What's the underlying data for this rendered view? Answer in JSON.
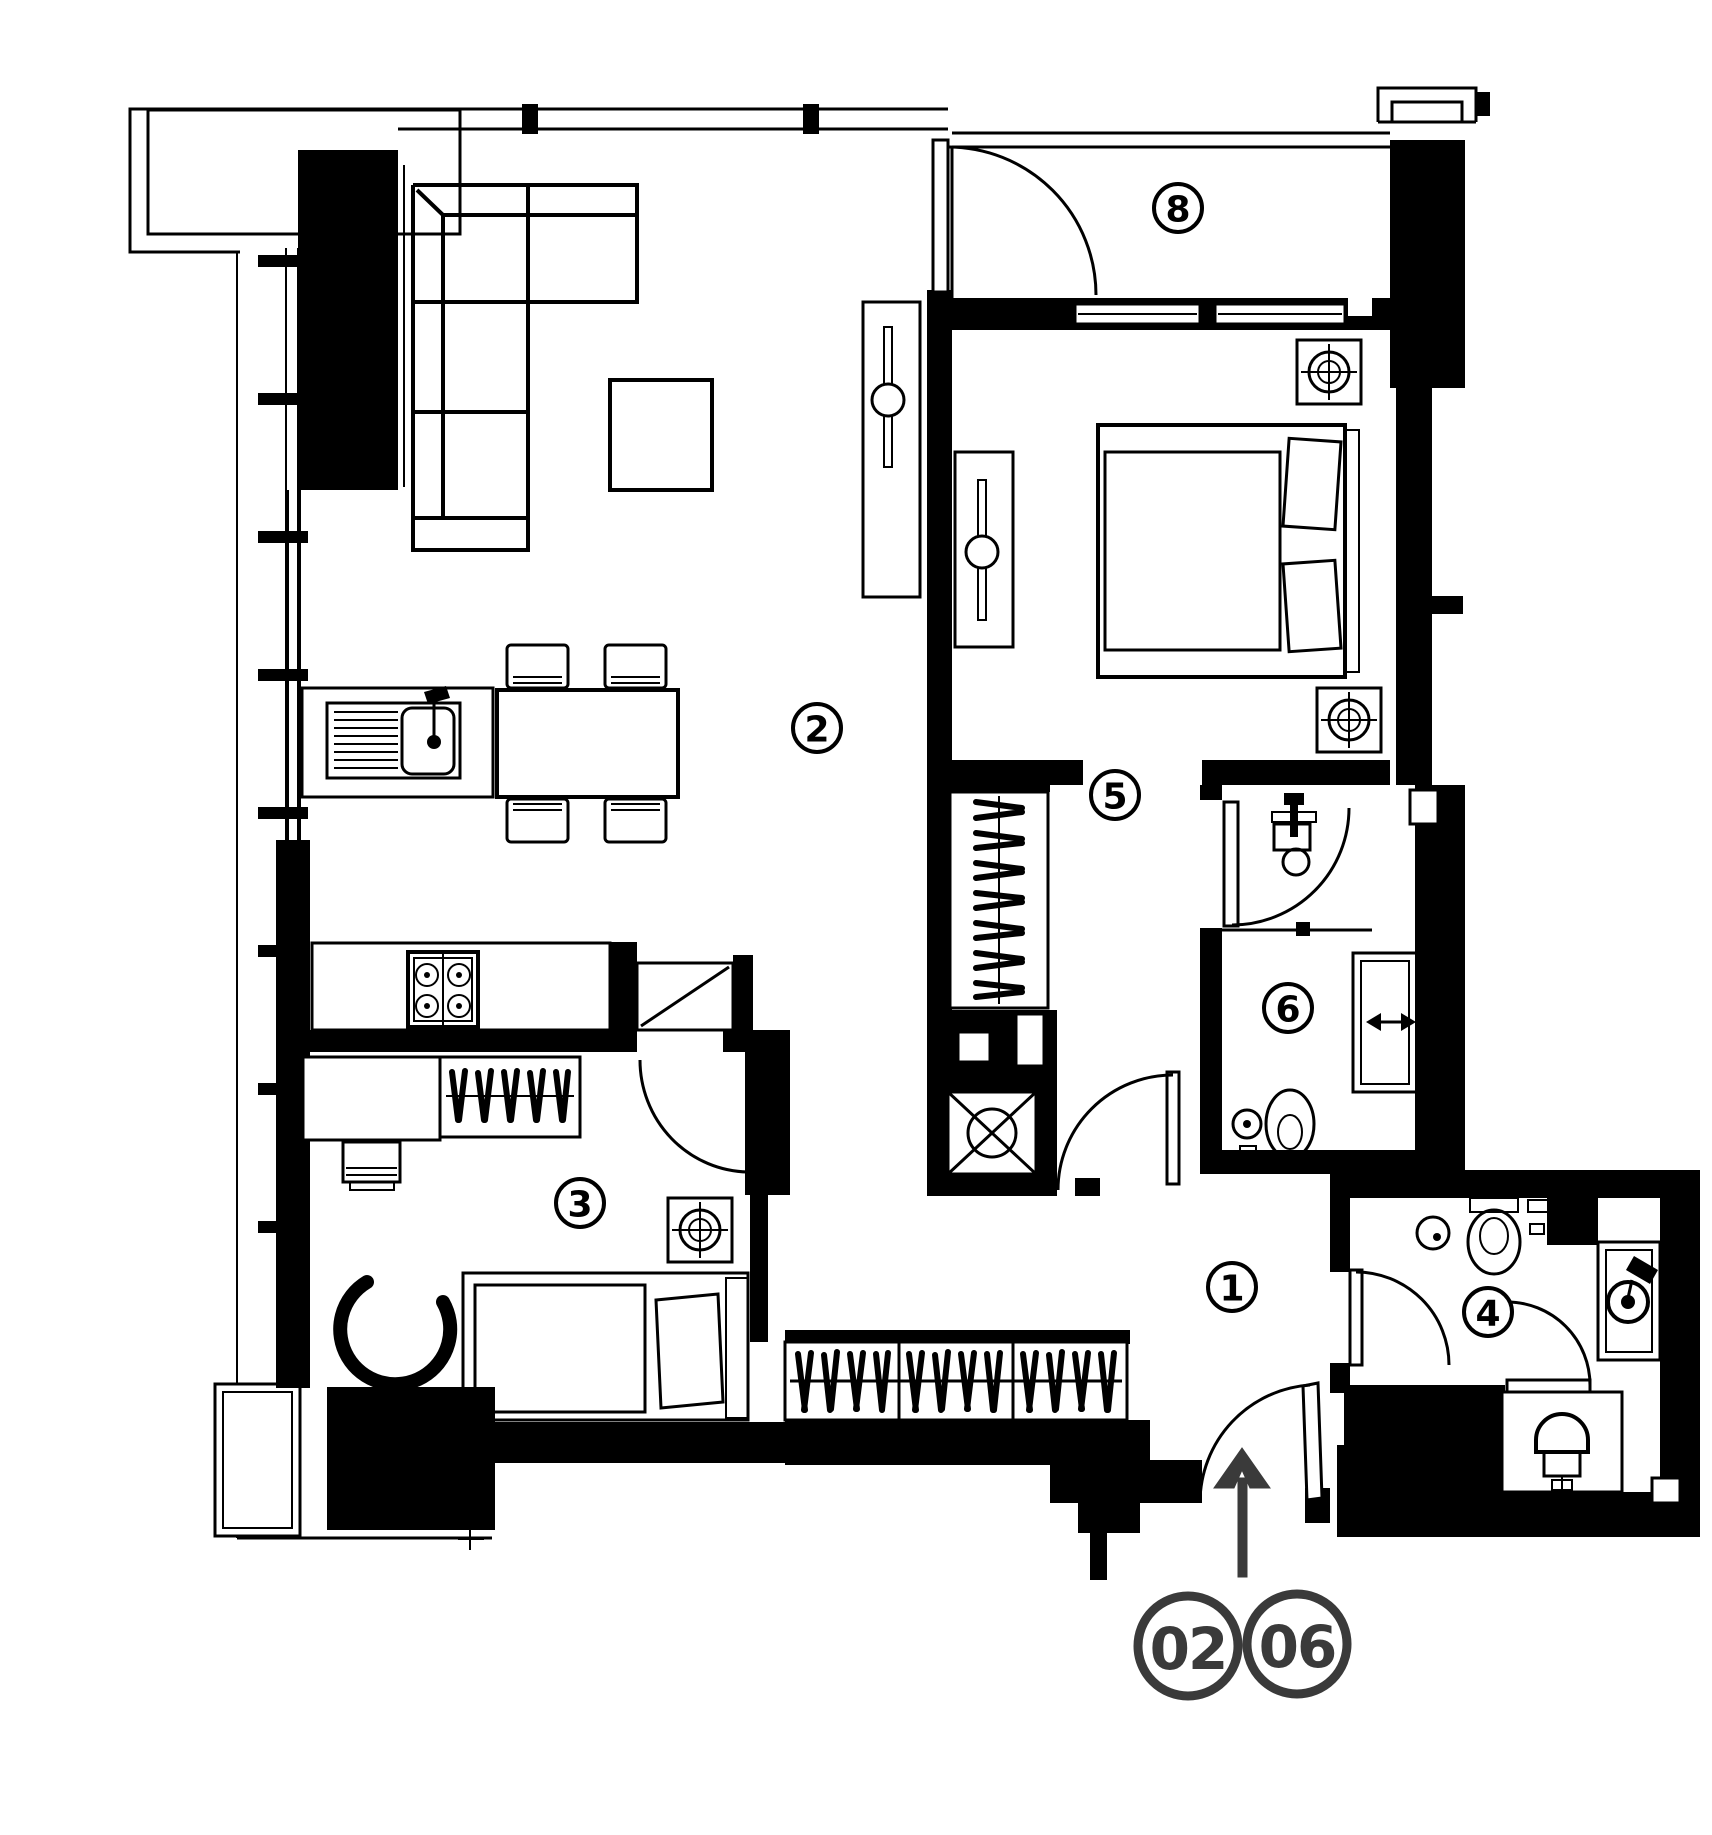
{
  "plan": {
    "rooms": [
      {
        "number": "1"
      },
      {
        "number": "2"
      },
      {
        "number": "3"
      },
      {
        "number": "4"
      },
      {
        "number": "5"
      },
      {
        "number": "6"
      },
      {
        "number": "8"
      }
    ],
    "unit_badges": [
      {
        "number": "02"
      },
      {
        "number": "06"
      }
    ],
    "colors": {
      "line": "#000000",
      "background": "#ffffff",
      "accent": "#3a3a3a"
    },
    "icons": {
      "entrance_arrow": "up-arrow",
      "ceiling_light": "circled-crosshair-in-square",
      "service_shaft": "box-with-x-and-circle",
      "hanger_rail": "slash-strokes-on-rail"
    }
  }
}
